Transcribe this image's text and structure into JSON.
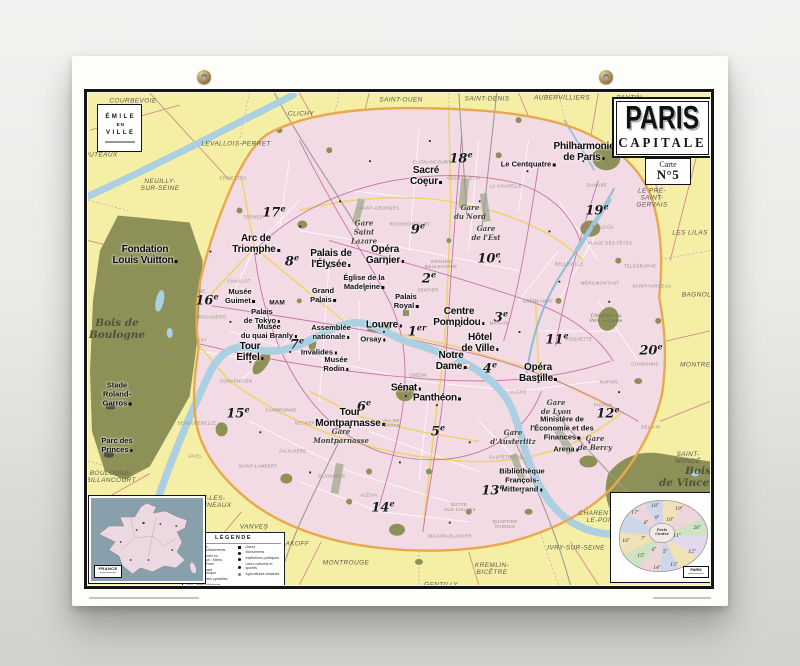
{
  "poster": {
    "title": "PARIS",
    "subtitle": "CAPITALE",
    "carte_label": "Carte",
    "carte_number": "N°5",
    "logo": {
      "row1": "ÉMILE",
      "row2": "EN",
      "row3": "VILLE"
    }
  },
  "legend": {
    "title": "LÉGENDE",
    "columns": [
      {
        "items": [
          {
            "sw": "dash",
            "label": "Limites d'arrondissements"
          },
          {
            "sw": "pink",
            "label": "Transports en commun : Métro, RER, Tram"
          },
          {
            "sw": "orange",
            "label": "Boulevard périphérique"
          },
          {
            "sw": "yellow",
            "label": "Itinéraires cyclables"
          },
          {
            "sw": "gray",
            "label": "Aires piétonnes"
          }
        ]
      },
      {
        "items": [
          {
            "sw": "sq",
            "label": "Gares"
          },
          {
            "sw": "dot",
            "label": "Monuments"
          },
          {
            "sw": "dot",
            "label": "Institutions publiques"
          },
          {
            "sw": "dot",
            "label": "Lieux culturels et sportifs"
          },
          {
            "sw": "dotg",
            "label": "Agricultures urbaines"
          }
        ]
      }
    ]
  },
  "insets": {
    "france": {
      "label": "FRANCE"
    },
    "arrondissements": {
      "label": "PARIS",
      "items": [
        {
          "t": "17e",
          "x": 22,
          "y": 18
        },
        {
          "t": "18e",
          "x": 42,
          "y": 11
        },
        {
          "t": "19e",
          "x": 66,
          "y": 14
        },
        {
          "t": "20e",
          "x": 84,
          "y": 33
        },
        {
          "t": "16e",
          "x": 13,
          "y": 46
        },
        {
          "t": "8e",
          "x": 33,
          "y": 28
        },
        {
          "t": "9e",
          "x": 44,
          "y": 23
        },
        {
          "t": "10e",
          "x": 57,
          "y": 25
        },
        {
          "t": "11e",
          "x": 64,
          "y": 41
        },
        {
          "t": "12e",
          "x": 79,
          "y": 57
        },
        {
          "t": "5e",
          "x": 52,
          "y": 57
        },
        {
          "t": "6e",
          "x": 41,
          "y": 55
        },
        {
          "t": "7e",
          "x": 30,
          "y": 44
        },
        {
          "t": "13e",
          "x": 61,
          "y": 70
        },
        {
          "t": "14e",
          "x": 44,
          "y": 73
        },
        {
          "t": "15e",
          "x": 28,
          "y": 61
        },
        {
          "t": "Paris|Centre",
          "x": 49,
          "y": 38,
          "ctr": true
        }
      ]
    }
  },
  "map": {
    "labels": [
      {
        "t": "COURBEVOIE",
        "c": "sub",
        "x": 133,
        "y": 101
      },
      {
        "t": "PUTEAUX",
        "c": "sub",
        "x": 101,
        "y": 155
      },
      {
        "t": "NEUILLY-|SUR-SEINE",
        "c": "sub",
        "x": 160,
        "y": 185
      },
      {
        "t": "LEVALLOIS-PERRET",
        "c": "sub",
        "x": 236,
        "y": 144
      },
      {
        "t": "CLICHY",
        "c": "sub",
        "x": 301,
        "y": 114
      },
      {
        "t": "SAINT-OUEN",
        "c": "sub",
        "x": 401,
        "y": 100
      },
      {
        "t": "SAINT-DENIS",
        "c": "sub",
        "x": 487,
        "y": 99
      },
      {
        "t": "AUBERVILLIERS",
        "c": "sub",
        "x": 562,
        "y": 98
      },
      {
        "t": "PANTIN",
        "c": "sub",
        "x": 629,
        "y": 98
      },
      {
        "t": "LE PRÉ-|SAINT-|GERVAIS",
        "c": "sub",
        "x": 652,
        "y": 198
      },
      {
        "t": "LES LILAS",
        "c": "sub",
        "x": 690,
        "y": 233
      },
      {
        "t": "BAGNOLET",
        "c": "sub",
        "x": 701,
        "y": 295
      },
      {
        "t": "MONTREUIL",
        "c": "sub",
        "x": 701,
        "y": 365
      },
      {
        "t": "SAINT-|MANDÉ",
        "c": "sub",
        "x": 688,
        "y": 458
      },
      {
        "t": "CHARENTON-|LE-PONT",
        "c": "sub",
        "x": 602,
        "y": 517
      },
      {
        "t": "IVRY-SUR-SEINE",
        "c": "sub",
        "x": 576,
        "y": 548
      },
      {
        "t": "KREMLIN-|BICÊTRE",
        "c": "sub",
        "x": 492,
        "y": 569
      },
      {
        "t": "GENTILLY",
        "c": "sub",
        "x": 441,
        "y": 585
      },
      {
        "t": "MONTROUGE",
        "c": "sub",
        "x": 346,
        "y": 563
      },
      {
        "t": "MALAKOFF",
        "c": "sub",
        "x": 290,
        "y": 544
      },
      {
        "t": "VANVES",
        "c": "sub",
        "x": 254,
        "y": 527
      },
      {
        "t": "ISSY-LES-|MOULINEAUX",
        "c": "sub",
        "x": 208,
        "y": 502
      },
      {
        "t": "BOULOGNE-|BILLANCOURT",
        "c": "sub",
        "x": 111,
        "y": 477
      },
      {
        "t": "Bois de|Boulogne",
        "c": "bois",
        "x": 117,
        "y": 329
      },
      {
        "t": "Bois|de Vincennes",
        "c": "bois",
        "x": 698,
        "y": 477
      },
      {
        "t": "18e",
        "c": "arr",
        "x": 461,
        "y": 158
      },
      {
        "t": "17e",
        "c": "arr",
        "x": 274,
        "y": 212
      },
      {
        "t": "9e",
        "c": "arr",
        "x": 418,
        "y": 229
      },
      {
        "t": "19e",
        "c": "arr",
        "x": 597,
        "y": 210
      },
      {
        "t": "10e",
        "c": "arr",
        "x": 489,
        "y": 258
      },
      {
        "t": "8e",
        "c": "arr",
        "x": 292,
        "y": 261
      },
      {
        "t": "2e",
        "c": "arr",
        "x": 429,
        "y": 278
      },
      {
        "t": "16e",
        "c": "arr",
        "x": 207,
        "y": 300
      },
      {
        "t": "3e",
        "c": "arr",
        "x": 501,
        "y": 317
      },
      {
        "t": "1er",
        "c": "arr",
        "x": 417,
        "y": 331
      },
      {
        "t": "11e",
        "c": "arr",
        "x": 557,
        "y": 339
      },
      {
        "t": "7e",
        "c": "arr",
        "x": 297,
        "y": 344
      },
      {
        "t": "20e",
        "c": "arr",
        "x": 651,
        "y": 350
      },
      {
        "t": "4e",
        "c": "arr",
        "x": 490,
        "y": 368
      },
      {
        "t": "6e",
        "c": "arr",
        "x": 364,
        "y": 406
      },
      {
        "t": "15e",
        "c": "arr",
        "x": 238,
        "y": 413
      },
      {
        "t": "12e",
        "c": "arr",
        "x": 608,
        "y": 413
      },
      {
        "t": "5e",
        "c": "arr",
        "x": 438,
        "y": 431
      },
      {
        "t": "13e",
        "c": "arr",
        "x": 493,
        "y": 490
      },
      {
        "t": "14e",
        "c": "arr",
        "x": 383,
        "y": 507
      },
      {
        "t": "Sacré|Coeur",
        "c": "m1",
        "x": 426,
        "y": 176
      },
      {
        "t": "Philharmonie|de Paris",
        "c": "m1",
        "x": 584,
        "y": 152
      },
      {
        "t": "Opéra|Garnier",
        "c": "m1",
        "x": 385,
        "y": 255
      },
      {
        "t": "Palais de|l'Élysée",
        "c": "m1",
        "x": 331,
        "y": 259
      },
      {
        "t": "Arc de|Triomphe",
        "c": "m1",
        "x": 256,
        "y": 244
      },
      {
        "t": "Fondation|Louis Vuitton",
        "c": "m1",
        "x": 145,
        "y": 255
      },
      {
        "t": "Tour|Eiffel",
        "c": "m1",
        "x": 250,
        "y": 352
      },
      {
        "t": "Louvre",
        "c": "m1",
        "x": 384,
        "y": 325
      },
      {
        "t": "Centre|Pompidou",
        "c": "m1",
        "x": 459,
        "y": 317
      },
      {
        "t": "Hôtel|de Ville",
        "c": "m1",
        "x": 480,
        "y": 343
      },
      {
        "t": "Notre|Dame",
        "c": "m1",
        "x": 451,
        "y": 361
      },
      {
        "t": "Opéra|Bastille",
        "c": "m1",
        "x": 538,
        "y": 373
      },
      {
        "t": "Sénat",
        "c": "m1",
        "x": 406,
        "y": 388
      },
      {
        "t": "Panthéon",
        "c": "m1",
        "x": 437,
        "y": 398
      },
      {
        "t": "Tour|Montparnasse",
        "c": "m1",
        "x": 350,
        "y": 418
      },
      {
        "t": "Le Centquatre",
        "c": "m2",
        "x": 528,
        "y": 164
      },
      {
        "t": "Église de la|Madeleine",
        "c": "m2",
        "x": 364,
        "y": 282
      },
      {
        "t": "Musée|Guimet",
        "c": "m2",
        "x": 240,
        "y": 296
      },
      {
        "t": "Palais|de Tokyo",
        "c": "m2",
        "x": 262,
        "y": 316
      },
      {
        "t": "Musée|du quai Branly",
        "c": "m2",
        "x": 269,
        "y": 331
      },
      {
        "t": "Grand|Palais",
        "c": "m2",
        "x": 323,
        "y": 295
      },
      {
        "t": "Invalides",
        "c": "m2",
        "x": 319,
        "y": 352
      },
      {
        "t": "Musée|Rodin",
        "c": "m2",
        "x": 336,
        "y": 364
      },
      {
        "t": "Assemblée|nationale",
        "c": "m2",
        "x": 331,
        "y": 332
      },
      {
        "t": "Orsay",
        "c": "m2",
        "x": 373,
        "y": 339
      },
      {
        "t": "Palais|Royal",
        "c": "m2",
        "x": 406,
        "y": 301
      },
      {
        "t": "Ministère de|l'Économie et des|Finances",
        "c": "m2",
        "x": 562,
        "y": 428
      },
      {
        "t": "Arena",
        "c": "m2",
        "x": 566,
        "y": 449
      },
      {
        "t": "Bibliothèque|François-|Mitterrand",
        "c": "m2",
        "x": 522,
        "y": 480
      },
      {
        "t": "Stade|Roland-|Garros",
        "c": "m2",
        "x": 117,
        "y": 394
      },
      {
        "t": "Parc des|Princes",
        "c": "m2",
        "x": 117,
        "y": 445
      },
      {
        "t": "MAM",
        "c": "m3",
        "x": 277,
        "y": 303
      },
      {
        "t": "Gare|du Nord",
        "c": "gare",
        "x": 470,
        "y": 212
      },
      {
        "t": "Gare|de l'Est",
        "c": "gare",
        "x": 486,
        "y": 233
      },
      {
        "t": "Gare|Saint|Lazare",
        "c": "gare",
        "x": 364,
        "y": 232
      },
      {
        "t": "Gare|Montparnasse",
        "c": "gare",
        "x": 341,
        "y": 436
      },
      {
        "t": "Gare|d'Austerlitz",
        "c": "gare",
        "x": 513,
        "y": 437
      },
      {
        "t": "Gare|de Lyon",
        "c": "gare",
        "x": 556,
        "y": 407
      },
      {
        "t": "Gare|de Bercy",
        "c": "gare",
        "x": 595,
        "y": 443
      },
      {
        "t": "Cimetière du|Père Lachaise",
        "c": "pit",
        "x": 606,
        "y": 319
      },
      {
        "t": "TERNES",
        "c": "q",
        "x": 253,
        "y": 217
      },
      {
        "t": "ÉPINETTES",
        "c": "q",
        "x": 233,
        "y": 178
      },
      {
        "t": "CLIGNANCOURT",
        "c": "q",
        "x": 432,
        "y": 162
      },
      {
        "t": "GOUTTE D'OR",
        "c": "q",
        "x": 464,
        "y": 178
      },
      {
        "t": "LA CHAPELLE",
        "c": "q",
        "x": 506,
        "y": 186
      },
      {
        "t": "SAINT-GEORGES",
        "c": "q",
        "x": 379,
        "y": 208
      },
      {
        "t": "ROCHECHOUART",
        "c": "q",
        "x": 410,
        "y": 224
      },
      {
        "t": "GRANDS|BOULEVARDS",
        "c": "q",
        "x": 441,
        "y": 264
      },
      {
        "t": "SENTIER",
        "c": "q",
        "x": 428,
        "y": 290
      },
      {
        "t": "MARAIS",
        "c": "q",
        "x": 499,
        "y": 323
      },
      {
        "t": "OBERKAMPF",
        "c": "q",
        "x": 538,
        "y": 301
      },
      {
        "t": "BELLEVILLE",
        "c": "q",
        "x": 569,
        "y": 264
      },
      {
        "t": "MÉNILMONTANT",
        "c": "q",
        "x": 600,
        "y": 283
      },
      {
        "t": "TÉLÉGRAPHE",
        "c": "q",
        "x": 640,
        "y": 266
      },
      {
        "t": "SAINT-FARGEAU",
        "c": "q",
        "x": 652,
        "y": 286
      },
      {
        "t": "LA MOUZAÏA",
        "c": "q",
        "x": 599,
        "y": 227
      },
      {
        "t": "PLACE DES FÊTES",
        "c": "q",
        "x": 610,
        "y": 243
      },
      {
        "t": "DANUBE",
        "c": "q",
        "x": 597,
        "y": 185
      },
      {
        "t": "CHARONNE",
        "c": "q",
        "x": 645,
        "y": 364
      },
      {
        "t": "ROQUETTE",
        "c": "q",
        "x": 579,
        "y": 339
      },
      {
        "t": "PICPUS",
        "c": "q",
        "x": 603,
        "y": 405
      },
      {
        "t": "BEL-AIR",
        "c": "q",
        "x": 651,
        "y": 427
      },
      {
        "t": "NATION",
        "c": "q",
        "x": 609,
        "y": 382
      },
      {
        "t": "ALIGRE",
        "c": "q",
        "x": 518,
        "y": 392
      },
      {
        "t": "QUARTIER|CHINOIS",
        "c": "q",
        "x": 505,
        "y": 524
      },
      {
        "t": "MAISON-BLANCHE",
        "c": "q",
        "x": 450,
        "y": 536
      },
      {
        "t": "BUTTE-|AUX-CAILLES",
        "c": "q",
        "x": 460,
        "y": 507
      },
      {
        "t": "VAL-DE-|GRÂCE",
        "c": "q",
        "x": 392,
        "y": 423
      },
      {
        "t": "SALPÊTRIÈRE",
        "c": "q",
        "x": 506,
        "y": 457
      },
      {
        "t": "ODÉON",
        "c": "q",
        "x": 418,
        "y": 375
      },
      {
        "t": "PLAISANCE",
        "c": "q",
        "x": 332,
        "y": 476
      },
      {
        "t": "ALÉSIA",
        "c": "q",
        "x": 369,
        "y": 495
      },
      {
        "t": "SAINT-LAMBERT",
        "c": "q",
        "x": 258,
        "y": 466
      },
      {
        "t": "CONVENTION",
        "c": "q",
        "x": 236,
        "y": 381
      },
      {
        "t": "CAMBRONNE",
        "c": "q",
        "x": 281,
        "y": 410
      },
      {
        "t": "NECKER",
        "c": "q",
        "x": 305,
        "y": 423
      },
      {
        "t": "FALGUIÈRE",
        "c": "q",
        "x": 293,
        "y": 451
      },
      {
        "t": "BEAUGRENELLE",
        "c": "q",
        "x": 197,
        "y": 423
      },
      {
        "t": "JAVEL",
        "c": "q",
        "x": 195,
        "y": 456
      },
      {
        "t": "AUTEUIL",
        "c": "q",
        "x": 139,
        "y": 390
      },
      {
        "t": "TROCADÉRO",
        "c": "q",
        "x": 211,
        "y": 317
      },
      {
        "t": "PASSY",
        "c": "q",
        "x": 199,
        "y": 340
      },
      {
        "t": "RANELAGH",
        "c": "q",
        "x": 177,
        "y": 353
      },
      {
        "t": "CHAILLOT",
        "c": "q",
        "x": 239,
        "y": 281
      },
      {
        "t": "DAUPHINE",
        "c": "q",
        "x": 193,
        "y": 291
      },
      {
        "t": "LA MUETTE",
        "c": "q",
        "x": 174,
        "y": 320
      }
    ]
  },
  "colors": {
    "suburb": "#f5efa6",
    "city": "#f2dbe5",
    "parks": "#8d9158",
    "water": "#abd0e2",
    "peripherique": "#e8a84c",
    "metro": "#c4679c",
    "roads": "#efd36e",
    "frame": "#151515"
  }
}
